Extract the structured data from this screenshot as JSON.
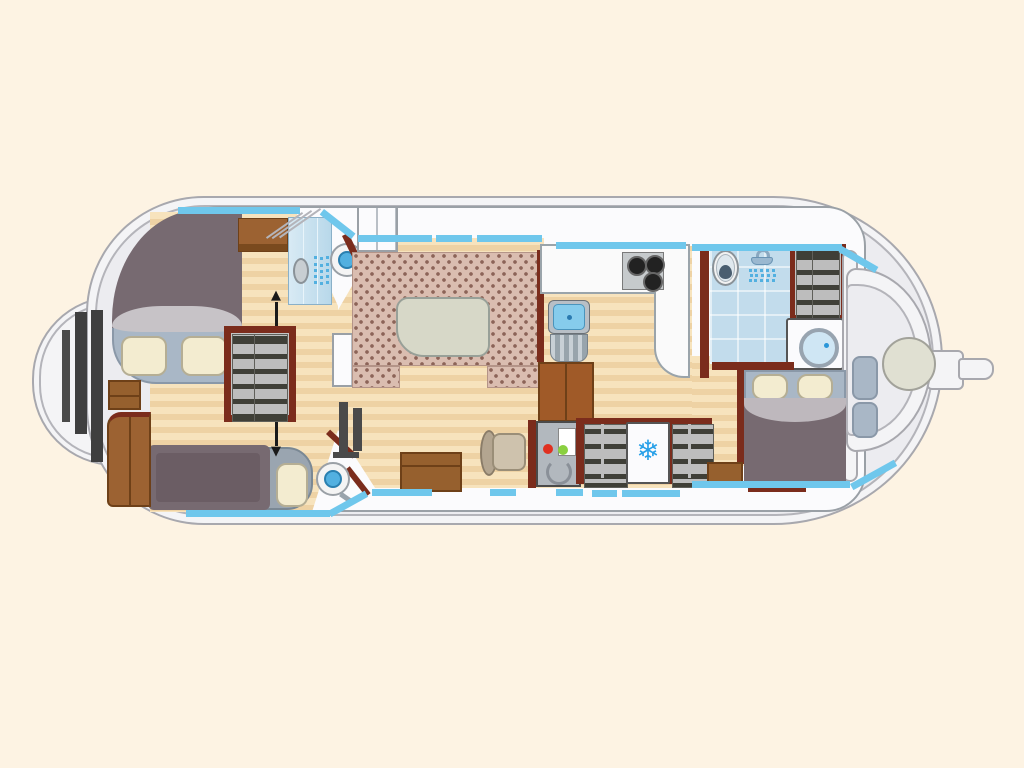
{
  "title": "boat-deck-floor-plan",
  "icons": {
    "snowflake": "❄",
    "arrow_up": "▲",
    "arrow_down": "▼"
  },
  "colors": {
    "background": "#fdf3e3",
    "hull_fill": "#f4f4f6",
    "hull_line": "#a8a8ae",
    "deck_fill": "#ececf0",
    "deck_line": "#b4b4ba",
    "cabin_line": "#9aa0a6",
    "wood_light": "#f7e3bd",
    "wood_dark": "#eed2a4",
    "wall_maroon": "#7b2c1c",
    "cabinet_brown": "#9c6232",
    "cabinet_dark": "#6e4018",
    "duvet_gray": "#776a71",
    "sheet_gray": "#c7c3c7",
    "headboard_blue": "#a9b7c6",
    "pillow_cream": "#f3ecd0",
    "upholstery": "#dabdb0",
    "upholstery_dot": "#8c6458",
    "table_gray": "#d7d8c8",
    "window_blue": "#6fc7ec",
    "bath_blue": "#c2dcec",
    "water_blue": "#52b0e0",
    "snowflake_blue": "#28a0e8",
    "steel_gray": "#b2b8be",
    "dark_steps": "#4a4a4a",
    "white": "#fbfbfd"
  },
  "legend": {
    "fixtures": [
      "bow-double-bed",
      "single-bed",
      "stern-double-bed",
      "salon-u-seating",
      "salon-table",
      "galley-stove-3-burners",
      "galley-sink",
      "refrigerator",
      "front-shower",
      "rear-shower",
      "toilet",
      "front-washbasin",
      "mid-washbasin",
      "washing-machine",
      "wardrobes",
      "steering-console",
      "stern-bench",
      "stern-round-table",
      "tiller"
    ]
  }
}
